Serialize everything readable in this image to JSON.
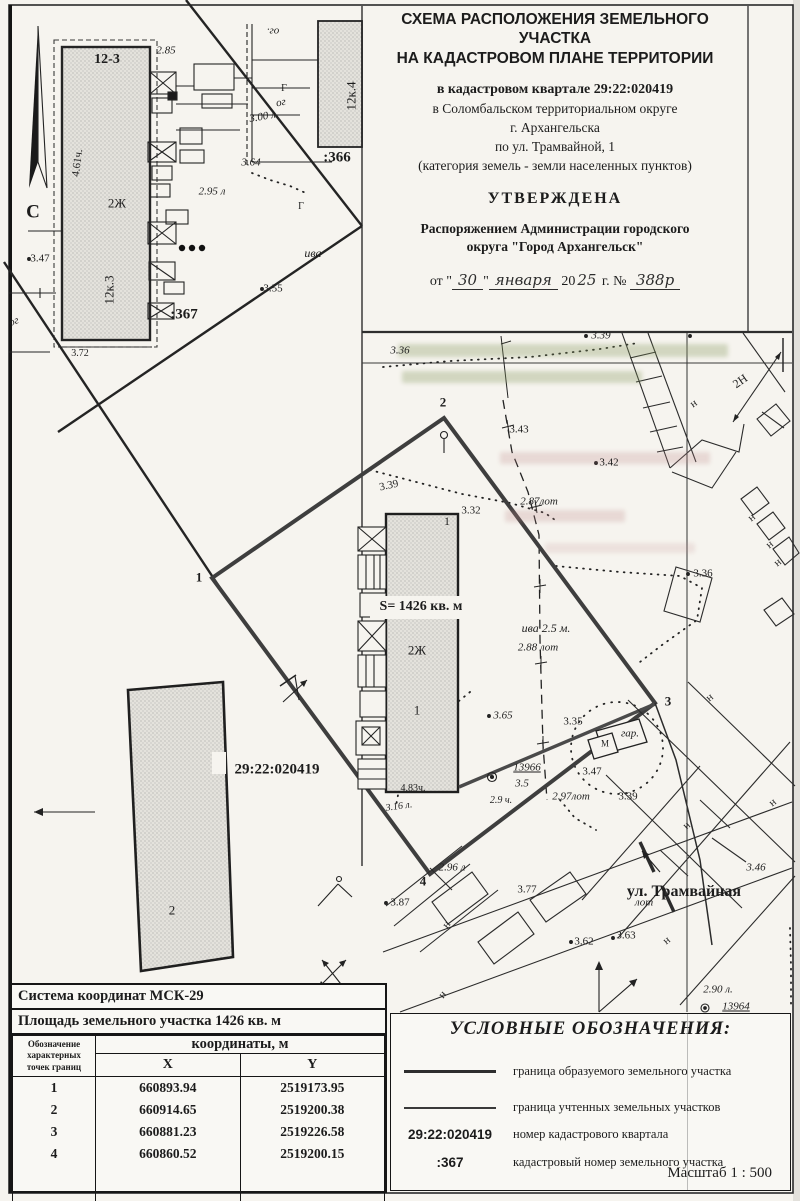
{
  "title_block": {
    "line1": "СХЕМА РАСПОЛОЖЕНИЯ ЗЕМЕЛЬНОГО УЧАСТКА",
    "line2": "НА КАДАСТРОВОМ ПЛАНЕ ТЕРРИТОРИИ",
    "quarter": "в кадастровом квартале 29:22:020419",
    "district": "в Соломбальском территориальном округе",
    "city": "г. Архангельска",
    "street": "по ул. Трамвайной, 1",
    "category": "(категория земель - земли населенных пунктов)",
    "approved": "УТВЕРЖДЕНА",
    "order_line1": "Распоряжением Администрации городского",
    "order_line2": "округа \"Город Архангельск\"",
    "date_prefix": "от \"",
    "date_day": "30",
    "date_quote": "\"",
    "date_month": "января",
    "date_year_printed": "20",
    "date_year_hand": "25",
    "date_suffix": "г. №",
    "order_number": "388р"
  },
  "coords_table": {
    "system_row": "Система координат МСК-29",
    "area_row": "Площадь земельного участка 1426 кв. м",
    "points_header": "Обозначение характерных точек границ",
    "coords_header": "координаты, м",
    "col_x": "X",
    "col_y": "Y",
    "rows": [
      {
        "n": "1",
        "x": "660893.94",
        "y": "2519173.95"
      },
      {
        "n": "2",
        "x": "660914.65",
        "y": "2519200.38"
      },
      {
        "n": "3",
        "x": "660881.23",
        "y": "2519226.58"
      },
      {
        "n": "4",
        "x": "660860.52",
        "y": "2519200.15"
      }
    ]
  },
  "legend": {
    "title": "УСЛОВНЫЕ ОБОЗНАЧЕНИЯ:",
    "items": [
      {
        "sample": "",
        "label": "граница образуемого земельного участка"
      },
      {
        "sample": "",
        "label": "граница учтенных земельных участков"
      },
      {
        "sample": "29:22:020419",
        "label": "номер кадастрового квартала"
      },
      {
        "sample": ":367",
        "label": "кадастровый номер земельного участка"
      }
    ],
    "scale": "Масштаб  1 : 500"
  },
  "map": {
    "area_label": "S= 1426 кв. м",
    "quarter_label": "29:22:020419",
    "labels": [
      {
        "t": "12-3",
        "x": 107,
        "y": 60,
        "s": 14,
        "b": 1
      },
      {
        "t": "2.85",
        "x": 166,
        "y": 51,
        "s": 11,
        "i": 1
      },
      {
        "t": "2.95 л",
        "x": 212,
        "y": 192,
        "s": 11,
        "i": 1
      },
      {
        "t": "4.61ч.",
        "x": 78,
        "y": 163,
        "s": 11,
        "r": -83
      },
      {
        "t": "2Ж",
        "x": 117,
        "y": 203,
        "s": 13
      },
      {
        "t": "12к.3",
        "x": 109,
        "y": 290,
        "s": 13,
        "r": -90
      },
      {
        "t": "3.47",
        "x": 40,
        "y": 259,
        "s": 11
      },
      {
        "t": ":367",
        "x": 184,
        "y": 315,
        "s": 15,
        "b": 1
      },
      {
        "t": "3.72",
        "x": 80,
        "y": 354,
        "s": 10
      },
      {
        "t": "ог",
        "x": 14,
        "y": 322,
        "s": 11,
        "i": 1,
        "r": -20
      },
      {
        "t": "ог.",
        "x": 273,
        "y": 31,
        "s": 11,
        "i": 1,
        "r": 180
      },
      {
        "t": "ог",
        "x": 281,
        "y": 103,
        "s": 11,
        "i": 1,
        "r": -12
      },
      {
        "t": "3.00 л.",
        "x": 264,
        "y": 117,
        "s": 11,
        "i": 1,
        "r": -10
      },
      {
        "t": "Г",
        "x": 284,
        "y": 89,
        "s": 10
      },
      {
        "t": "12к.4",
        "x": 351,
        "y": 96,
        "s": 13,
        "r": -90
      },
      {
        "t": ":366",
        "x": 337,
        "y": 158,
        "s": 15,
        "b": 1
      },
      {
        "t": "3.64",
        "x": 251,
        "y": 163,
        "s": 11,
        "i": 1
      },
      {
        "t": "ива",
        "x": 313,
        "y": 253,
        "s": 12,
        "i": 1
      },
      {
        "t": "3.55",
        "x": 273,
        "y": 289,
        "s": 11
      },
      {
        "t": "Г",
        "x": 301,
        "y": 207,
        "s": 10
      },
      {
        "t": "С",
        "x": 33,
        "y": 212,
        "s": 19,
        "b": 1
      },
      {
        "t": "3.36",
        "x": 400,
        "y": 351,
        "s": 11,
        "i": 1
      },
      {
        "t": "3.39",
        "x": 601,
        "y": 336,
        "s": 11,
        "i": 1
      },
      {
        "t": "2",
        "x": 443,
        "y": 402,
        "s": 13,
        "b": 1
      },
      {
        "t": "3.43",
        "x": 519,
        "y": 430,
        "s": 11
      },
      {
        "t": "2Н",
        "x": 740,
        "y": 381,
        "s": 12,
        "r": -35
      },
      {
        "t": "н",
        "x": 694,
        "y": 404,
        "s": 11,
        "r": -35
      },
      {
        "t": "3.42",
        "x": 609,
        "y": 463,
        "s": 11
      },
      {
        "t": "2.87лот",
        "x": 539,
        "y": 502,
        "s": 11,
        "i": 1
      },
      {
        "t": "3.32",
        "x": 471,
        "y": 511,
        "s": 11
      },
      {
        "t": "1",
        "x": 447,
        "y": 521,
        "s": 12
      },
      {
        "t": "3.39",
        "x": 389,
        "y": 486,
        "s": 11,
        "r": -12
      },
      {
        "t": "2Ж",
        "x": 417,
        "y": 650,
        "s": 13
      },
      {
        "t": "ива 2.5 м.",
        "x": 546,
        "y": 628,
        "s": 12,
        "i": 1
      },
      {
        "t": "2.88 лот",
        "x": 538,
        "y": 648,
        "s": 11,
        "i": 1
      },
      {
        "t": "3.36",
        "x": 703,
        "y": 574,
        "s": 11
      },
      {
        "t": "1",
        "x": 199,
        "y": 577,
        "s": 13,
        "b": 1
      },
      {
        "t": "1",
        "x": 417,
        "y": 710,
        "s": 13
      },
      {
        "t": "3.65",
        "x": 503,
        "y": 716,
        "s": 11,
        "i": 1
      },
      {
        "t": "3.35",
        "x": 573,
        "y": 722,
        "s": 11
      },
      {
        "t": "3",
        "x": 668,
        "y": 701,
        "s": 13,
        "b": 1
      },
      {
        "t": "гар.",
        "x": 630,
        "y": 734,
        "s": 11,
        "i": 1
      },
      {
        "t": "М",
        "x": 605,
        "y": 744,
        "s": 9
      },
      {
        "t": "3.47",
        "x": 592,
        "y": 772,
        "s": 11
      },
      {
        "t": "13966",
        "x": 527,
        "y": 768,
        "s": 11,
        "i": 1,
        "u": 1
      },
      {
        "t": "3.5",
        "x": 522,
        "y": 784,
        "s": 11,
        "i": 1
      },
      {
        "t": "29:22:020419",
        "x": 277,
        "y": 770,
        "s": 15,
        "b": 1
      },
      {
        "t": "4.83ч.",
        "x": 413,
        "y": 789,
        "s": 10
      },
      {
        "t": "3.16 л.",
        "x": 399,
        "y": 807,
        "s": 10,
        "i": 1,
        "r": -8
      },
      {
        "t": "2.9 ч.",
        "x": 501,
        "y": 801,
        "s": 10,
        "i": 1
      },
      {
        "t": "2.97лот",
        "x": 571,
        "y": 797,
        "s": 11,
        "i": 1
      },
      {
        "t": "3.39",
        "x": 628,
        "y": 797,
        "s": 11
      },
      {
        "t": "2",
        "x": 172,
        "y": 910,
        "s": 13
      },
      {
        "t": "2.96 л",
        "x": 452,
        "y": 868,
        "s": 11,
        "i": 1
      },
      {
        "t": "4",
        "x": 423,
        "y": 881,
        "s": 13,
        "b": 1
      },
      {
        "t": "3.87",
        "x": 400,
        "y": 903,
        "s": 11
      },
      {
        "t": "3.77",
        "x": 527,
        "y": 890,
        "s": 11
      },
      {
        "t": "ул. Трамвайная",
        "x": 684,
        "y": 892,
        "s": 16,
        "b": 1
      },
      {
        "t": "лот",
        "x": 644,
        "y": 903,
        "s": 11,
        "i": 1
      },
      {
        "t": "3.62",
        "x": 584,
        "y": 942,
        "s": 11
      },
      {
        "t": "3.63",
        "x": 626,
        "y": 936,
        "s": 11
      },
      {
        "t": "н",
        "x": 667,
        "y": 941,
        "s": 11,
        "r": -40
      },
      {
        "t": "3.46",
        "x": 756,
        "y": 868,
        "s": 11,
        "i": 1
      },
      {
        "t": "2.90 л.",
        "x": 718,
        "y": 990,
        "s": 11,
        "i": 1
      },
      {
        "t": "13964",
        "x": 736,
        "y": 1007,
        "s": 11,
        "i": 1,
        "u": 1
      },
      {
        "t": "н",
        "x": 447,
        "y": 925,
        "s": 11,
        "r": -50
      },
      {
        "t": "н",
        "x": 443,
        "y": 995,
        "s": 11,
        "r": -50
      },
      {
        "t": "н",
        "x": 752,
        "y": 518,
        "s": 11,
        "r": -40
      },
      {
        "t": "н",
        "x": 770,
        "y": 545,
        "s": 11,
        "r": -40
      },
      {
        "t": "н",
        "x": 778,
        "y": 563,
        "s": 11,
        "r": -40
      },
      {
        "t": "н",
        "x": 710,
        "y": 698,
        "s": 11,
        "r": -40
      },
      {
        "t": "н",
        "x": 773,
        "y": 803,
        "s": 11,
        "r": -40
      },
      {
        "t": "н",
        "x": 687,
        "y": 826,
        "s": 11,
        "r": -40
      }
    ]
  }
}
